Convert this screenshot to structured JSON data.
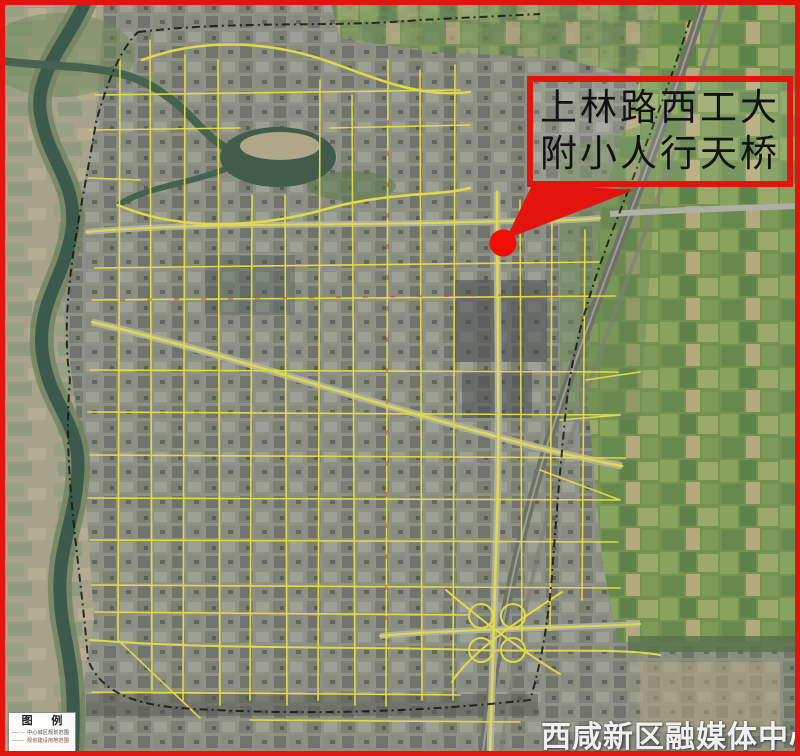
{
  "frame": {
    "border_color": "#e3140e"
  },
  "callout": {
    "line1": "上林路西工大",
    "line2": "附小人行天桥",
    "border_color": "#e3140e",
    "text_color": "#121212"
  },
  "marker": {
    "name": "pedestrian-bridge-location",
    "color": "#ee0f06"
  },
  "legend": {
    "title": "图 例",
    "items": [
      {
        "symbol": "—··—",
        "label": "中心城区规划范围"
      },
      {
        "symbol": "——",
        "label": "规划建设用地范围"
      }
    ]
  },
  "watermark": {
    "text": "西咸新区融媒体中心",
    "color": "#ffffff"
  },
  "map": {
    "kind": "satellite-planning-map",
    "road_color": "#e0da48",
    "boundary_style": "black-dashed",
    "water_color": "#3c5a4c",
    "farmland_color": "#74924f"
  }
}
